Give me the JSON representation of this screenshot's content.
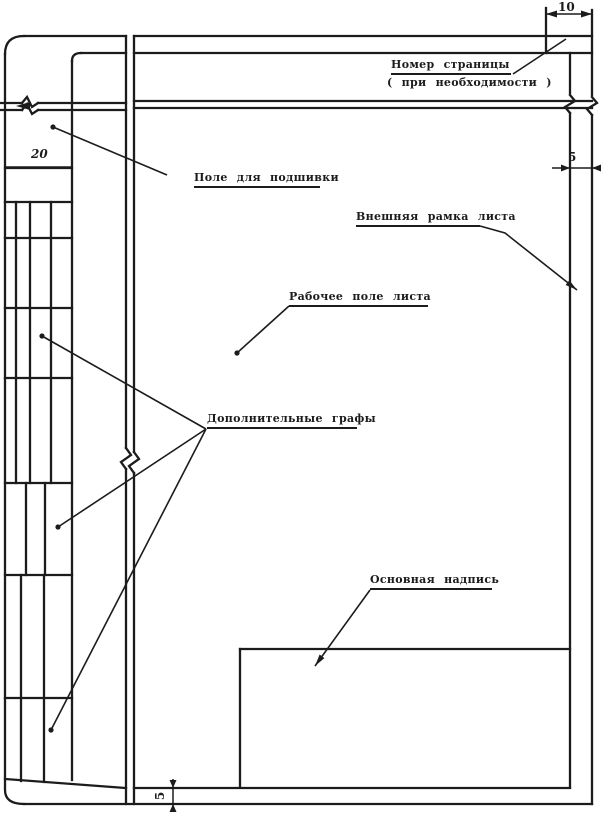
{
  "diagram": {
    "labels": {
      "page_number_line1": "Номер страницы",
      "page_number_line2": "( при  необходимости )",
      "filing_field": "Поле для подшивки",
      "outer_frame": "Внешняя рамка листа",
      "working_field": "Рабочее поле листа",
      "extra_columns": "Дополнительные графы",
      "title_block": "Основная надпись"
    },
    "dimensions": {
      "top_margin_width": "10",
      "filing_margin_width": "20",
      "right_margin_width": "5",
      "bottom_margin_width": "5"
    },
    "ink_color": "#1c1c1c",
    "paper_color": "#ffffff"
  }
}
